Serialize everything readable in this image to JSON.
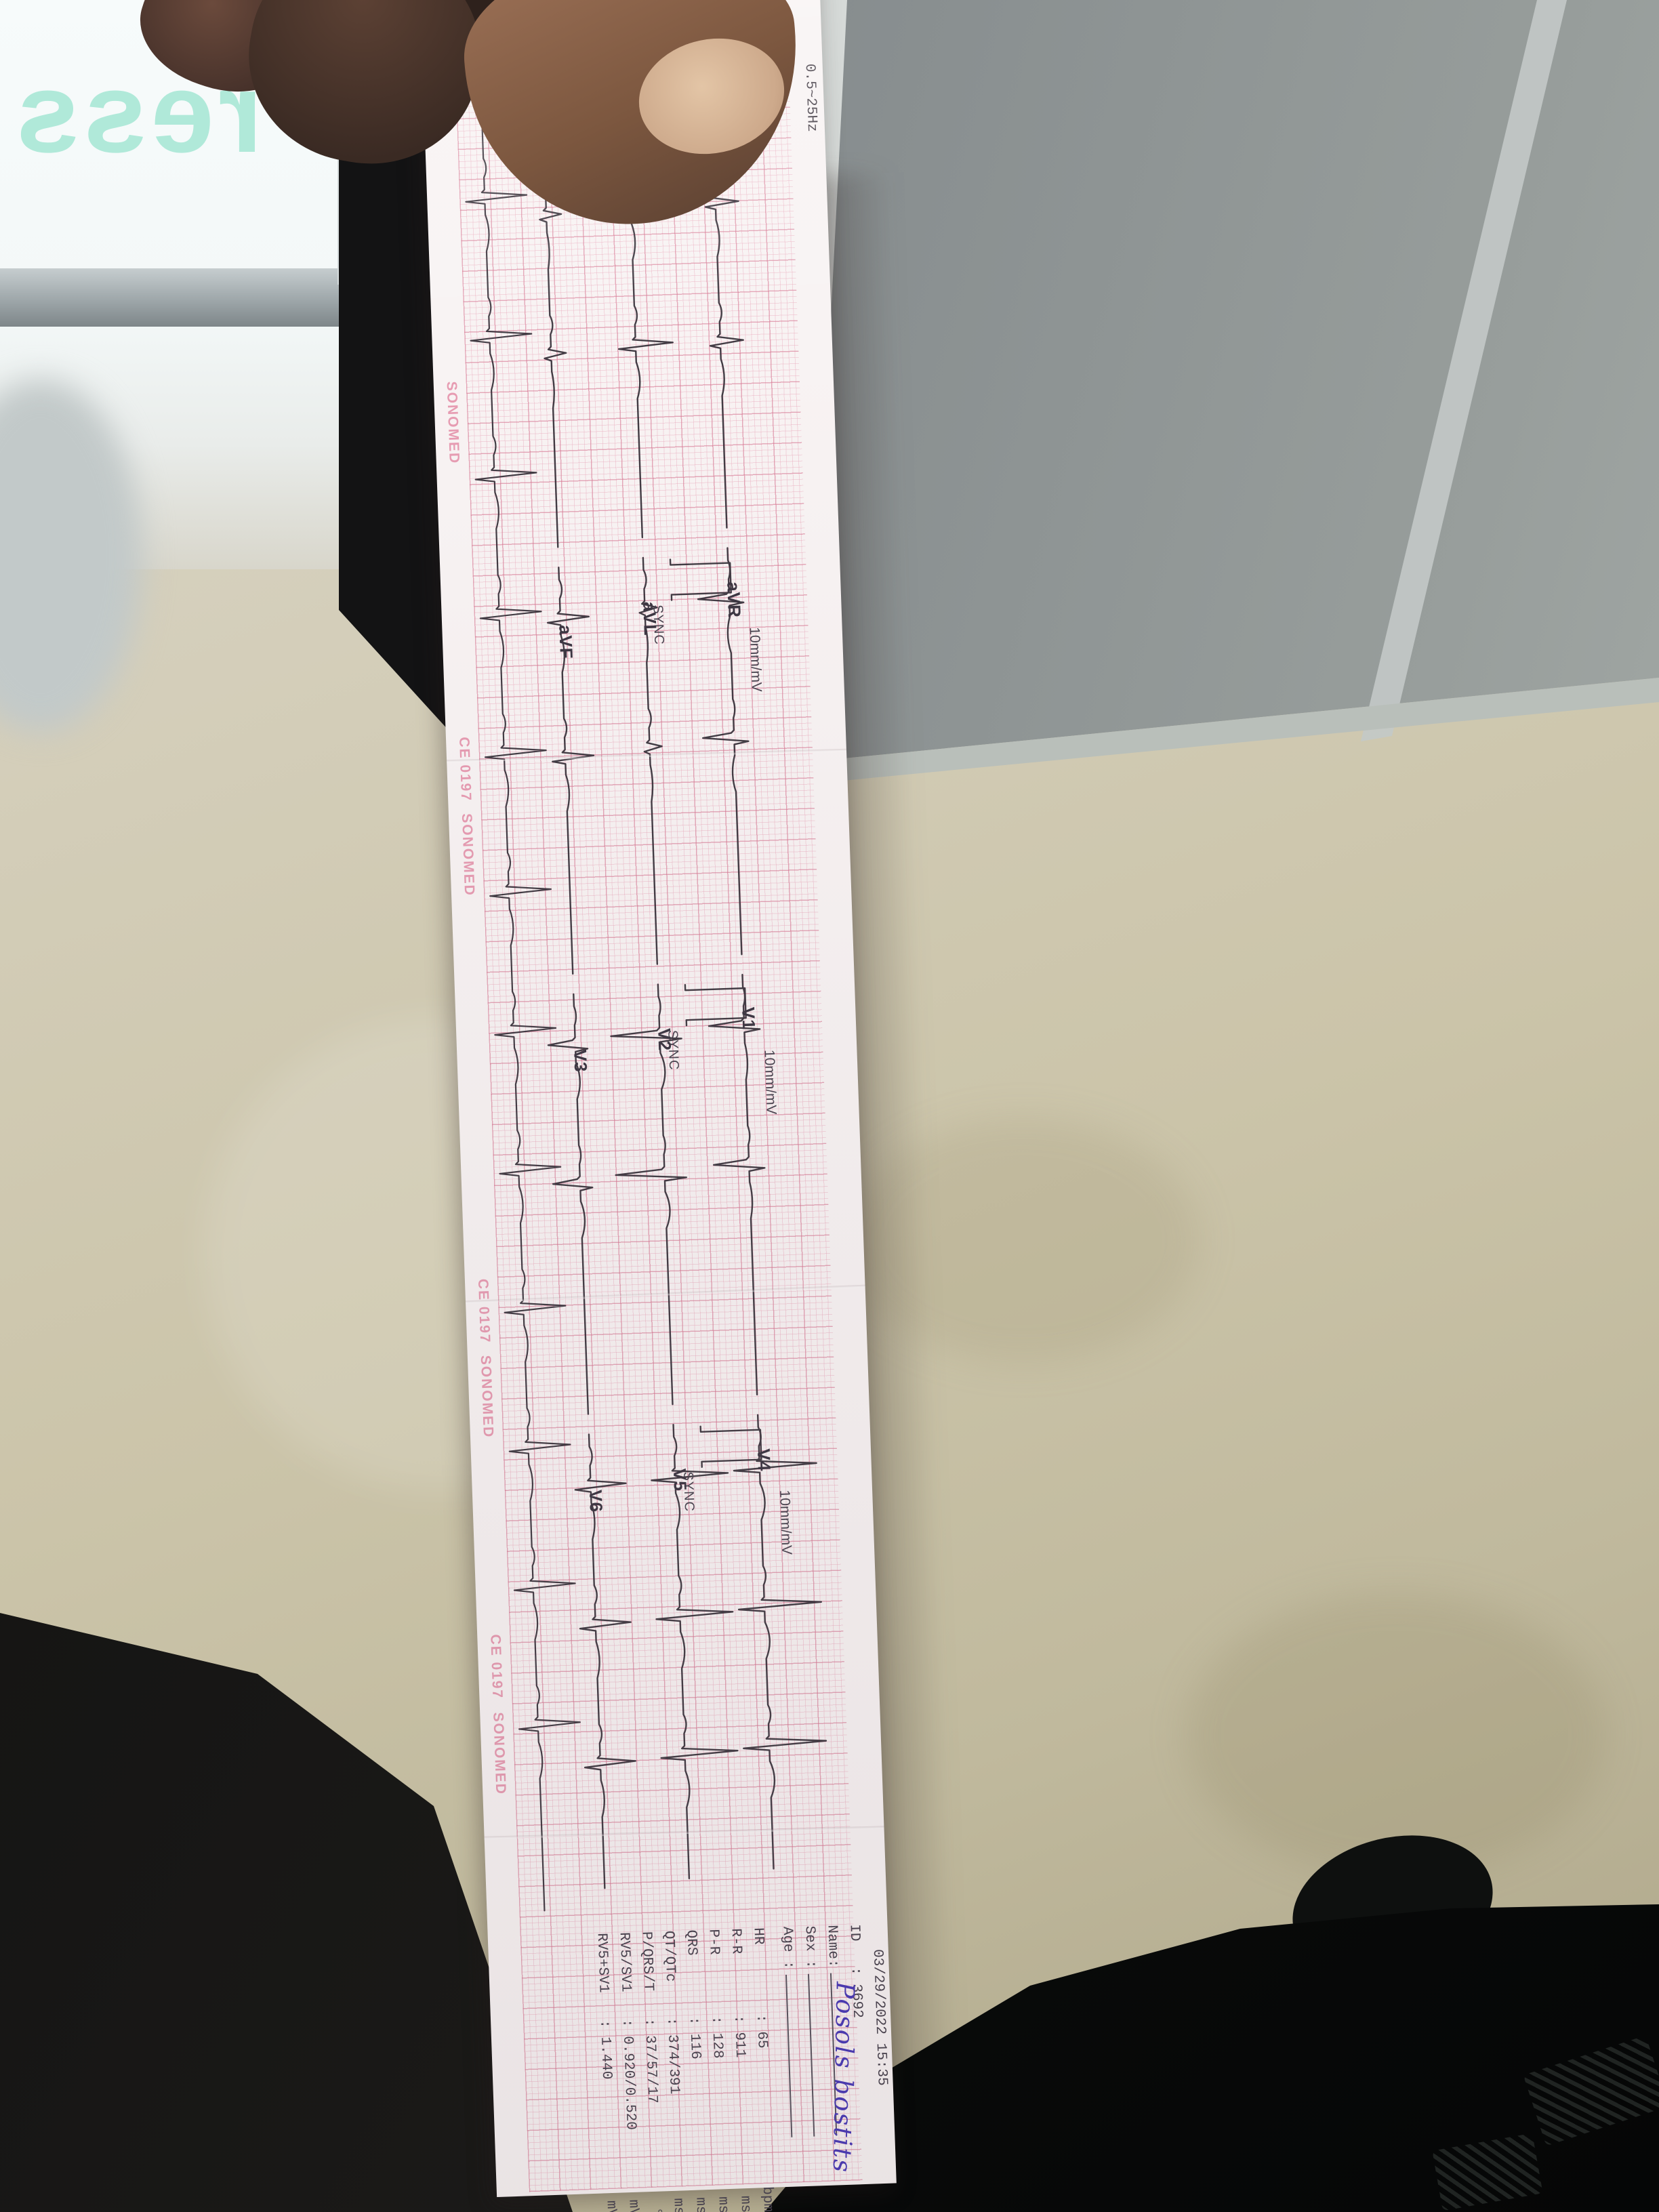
{
  "glass_decal": {
    "text": "ress"
  },
  "ecg": {
    "gain": "10mm/mV",
    "sync": "SYNC",
    "header_filter": "0.5~25Hz",
    "rhythm_lead": "II",
    "side_texts": [
      "SONOMED",
      "CE 0197",
      "SONOMED",
      "CE 0197",
      "SONOMED",
      "CE 0197",
      "SONOMED"
    ],
    "sections": [
      {
        "leads": [
          "I",
          "II",
          "III"
        ]
      },
      {
        "leads": [
          "aVR",
          "aVL",
          "aVF"
        ]
      },
      {
        "leads": [
          "V1",
          "V2",
          "V3"
        ]
      },
      {
        "leads": [
          "V4",
          "V5",
          "V6"
        ]
      }
    ],
    "info": {
      "datetime": "03/29/2022 15:35",
      "id_label": "ID",
      "id_value": ": 3692",
      "name_label": "Name:",
      "name_value": "Posols bostits",
      "sex_label": "Sex :",
      "age_label": "Age :",
      "measurements": [
        {
          "label": "HR",
          "value": ": 65",
          "unit": "bpm"
        },
        {
          "label": "R-R",
          "value": ": 911",
          "unit": "ms"
        },
        {
          "label": "P-R",
          "value": ": 128",
          "unit": "ms"
        },
        {
          "label": "QRS",
          "value": ": 116",
          "unit": "ms"
        },
        {
          "label": "QT/QTc",
          "value": ": 374/391",
          "unit": "ms"
        },
        {
          "label": "P/QRS/T",
          "value": ": 37/57/17",
          "unit": "°"
        },
        {
          "label": "RV5/SV1",
          "value": ": 0.920/0.520",
          "unit": "mV"
        },
        {
          "label": "RV5+SV1",
          "value": ": 1.440",
          "unit": "mV"
        }
      ]
    }
  }
}
